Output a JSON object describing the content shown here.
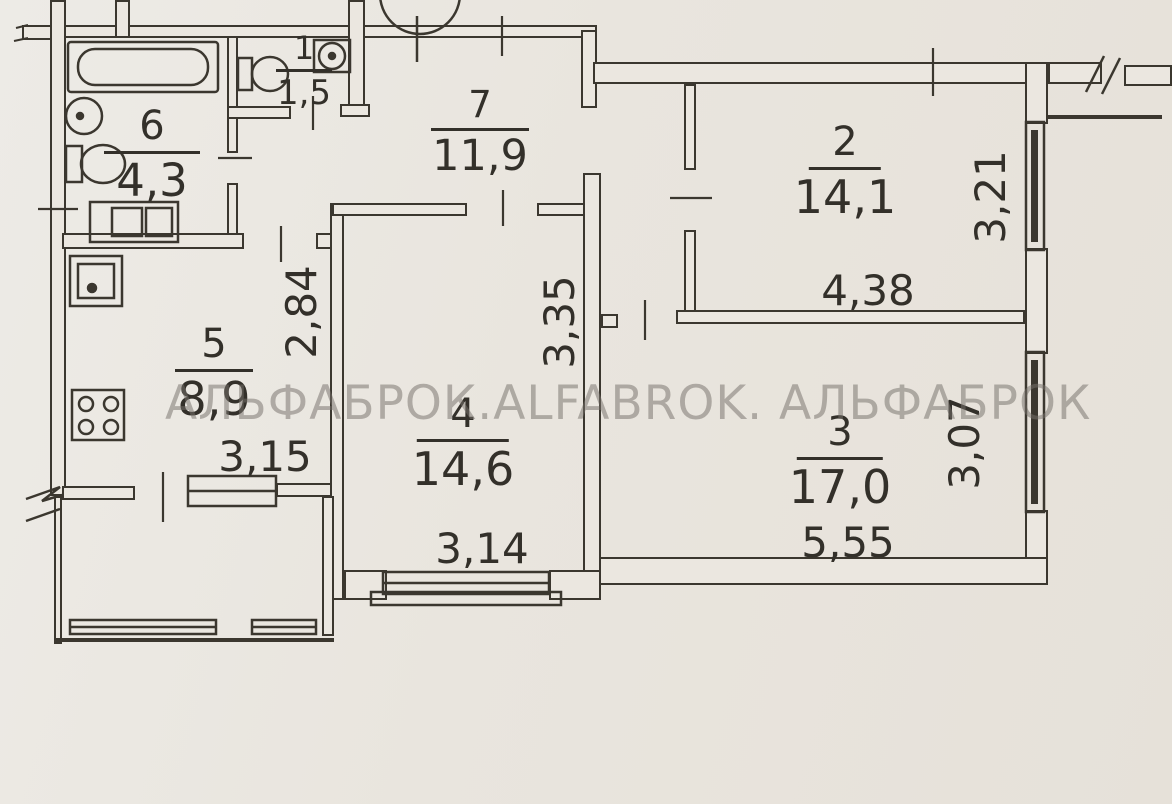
{
  "watermark": "АЛЬФАБРОК.ALFABROK. АЛЬФАБРОК",
  "rooms": {
    "r6": {
      "number": "6",
      "area": "4,3"
    },
    "r1": {
      "number": "1",
      "area": "1,5"
    },
    "r7": {
      "number": "7",
      "area": "11,9"
    },
    "r2": {
      "number": "2",
      "area": "14,1"
    },
    "r5": {
      "number": "5",
      "area": "8,9"
    },
    "r4": {
      "number": "4",
      "area": "14,6"
    },
    "r3": {
      "number": "3",
      "area": "17,0"
    }
  },
  "dimensions": {
    "room2_width": "4,38",
    "room2_depth": "3,21",
    "room3_width": "5,55",
    "room3_depth": "3,07",
    "room4_width": "3,14",
    "room4_depth": "3,35",
    "kitchen_depth": "2,84",
    "kitchen_width": "3,15"
  }
}
